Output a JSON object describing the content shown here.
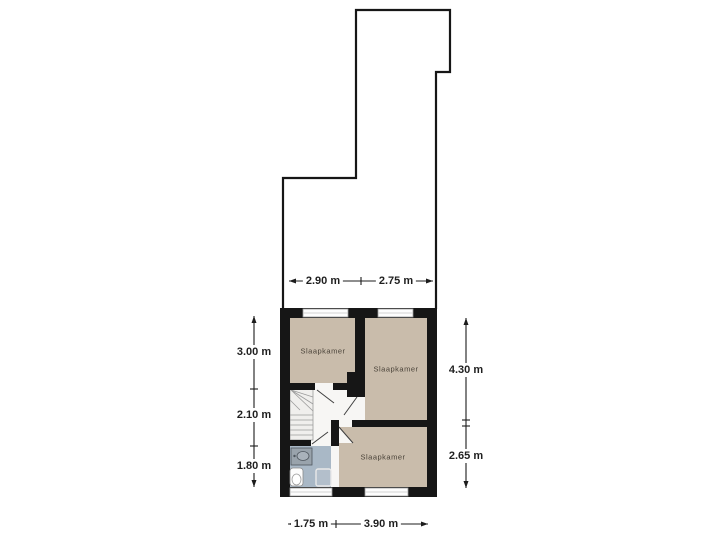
{
  "plan": {
    "type": "floorplan",
    "rooms": [
      {
        "name": "Slaapkamer"
      },
      {
        "name": "Slaapkamer"
      },
      {
        "name": "Slaapkamer"
      }
    ],
    "dimensions": {
      "top": [
        "2.90 m",
        "2.75 m"
      ],
      "left": [
        "3.00 m",
        "2.10 m",
        "1.80 m"
      ],
      "right": [
        "4.30 m",
        "2.65 m"
      ],
      "bottom": [
        "1.75 m",
        "3.90 m"
      ]
    },
    "fixtures": {
      "stairs": "stairs-icon",
      "sink": "sink-icon",
      "toilet": "toilet-icon",
      "shower": "shower-icon"
    },
    "colors": {
      "background": "#ffffff",
      "wall": "#161616",
      "outline": "#161616",
      "room_fill": "#c9bcab",
      "hall_fill": "#f7f6f4",
      "bathroom_floor": "#a9b8c6",
      "window": "#fdfdfd",
      "stairs_fill": "#f0efed",
      "sink_fill": "#99a3ac",
      "shower_fill": "#b3bfcb",
      "dimension_text": "#1f1f1f"
    }
  }
}
